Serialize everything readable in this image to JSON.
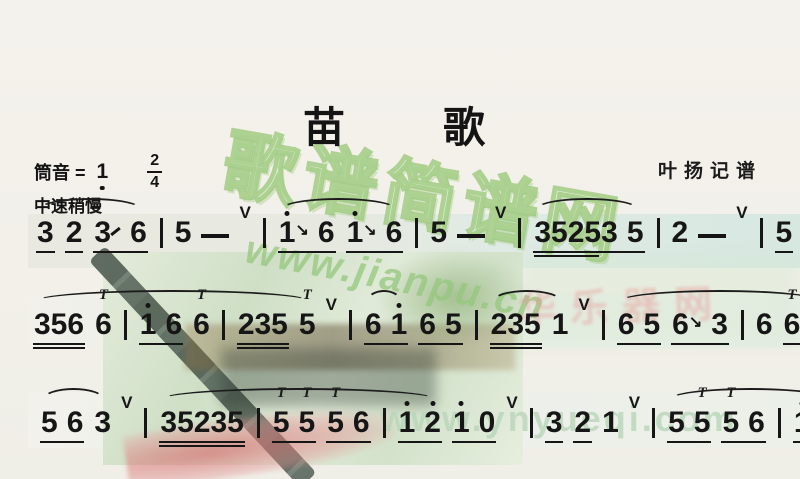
{
  "header": {
    "title": "苗歌",
    "title_chars": [
      "苗",
      "歌"
    ],
    "credit": "叶扬记谱"
  },
  "key_line": {
    "prefix": "筒音 =",
    "tonic": "1",
    "tonic_low_octave": true,
    "time_numerator": "2",
    "time_denominator": "4",
    "tempo": "中速稍慢"
  },
  "watermarks": {
    "bubble": "歌谱简谱网",
    "url_mid": "www.jianpu.cn",
    "url_bottom": "www.ynyueqi.com",
    "pink": "华乐器网"
  },
  "colors": {
    "ink": "#161616",
    "page": "#f2f0e9",
    "watermark_green": "#94c77c",
    "watermark_pale_green": "#b8d6b9",
    "watermark_pink": "#e79292",
    "photo_green": "#cfdfc6",
    "tassel_red": "#d66e6e"
  },
  "score": {
    "glyphs": {
      "ornament": "T",
      "breath": "V",
      "slide_down": "↘"
    },
    "lines_text": [
      "3 2 3/6 | 5 - v| 1'6 1'6 | 5 - v| 35253 5 | 2 - v| 5 5 5 32 |",
      "356 6 | 1' 6 6 | 235 5 v| 6 1' 6 5 | 235 1 v| 6 5 6\\3 | 6 6 1' |",
      "5 6 3 v| 35235 | 5 5 5 6 | 1' 2' 1' 0 v| 3 2 1 v| 5 5 5 6 | 1' 2' 1' 0 ||"
    ],
    "lines": [
      {
        "segments": [
          {
            "slur": true,
            "tokens": [
              {
                "k": "beam",
                "u": 1,
                "notes": [
                  {
                    "t": "3"
                  }
                ]
              },
              {
                "k": "beam",
                "u": 1,
                "notes": [
                  {
                    "t": "2"
                  }
                ]
              },
              {
                "k": "beam",
                "u": 1,
                "notes": [
                  {
                    "t": "3",
                    "slide": "up"
                  },
                  {
                    "t": "6"
                  }
                ]
              }
            ]
          },
          {
            "slur": false,
            "tokens": [
              {
                "k": "bar"
              },
              {
                "k": "note",
                "t": "5"
              },
              {
                "k": "dash"
              },
              {
                "k": "breath"
              },
              {
                "k": "bar"
              }
            ]
          },
          {
            "slur": true,
            "tokens": [
              {
                "k": "beam",
                "u": 1,
                "notes": [
                  {
                    "t": "1",
                    "da": 1,
                    "slide": "down"
                  },
                  {
                    "t": "6"
                  }
                ]
              },
              {
                "k": "beam",
                "u": 1,
                "notes": [
                  {
                    "t": "1",
                    "da": 1,
                    "slide": "down"
                  },
                  {
                    "t": "6"
                  }
                ]
              }
            ]
          },
          {
            "slur": false,
            "tokens": [
              {
                "k": "bar"
              },
              {
                "k": "note",
                "t": "5"
              },
              {
                "k": "dash"
              },
              {
                "k": "breath"
              },
              {
                "k": "bar"
              }
            ]
          },
          {
            "slur": true,
            "tokens": [
              {
                "k": "beam",
                "u": 1,
                "notes": [
                  {
                    "t": "35253",
                    "u2": 0.78
                  },
                  {
                    "t": "5"
                  }
                ]
              }
            ]
          },
          {
            "slur": false,
            "tokens": [
              {
                "k": "bar"
              },
              {
                "k": "note",
                "t": "2"
              },
              {
                "k": "dash"
              },
              {
                "k": "breath"
              },
              {
                "k": "bar"
              },
              {
                "k": "beam",
                "u": 1,
                "notes": [
                  {
                    "t": "5"
                  }
                ]
              },
              {
                "k": "beam",
                "u": 1,
                "notes": [
                  {
                    "t": "5",
                    "orn": 1
                  }
                ]
              },
              {
                "k": "beam",
                "u": 1,
                "notes": [
                  {
                    "t": "5",
                    "orn": 1
                  }
                ]
              },
              {
                "k": "beam",
                "u": 2,
                "notes": [
                  {
                    "t": "32"
                  }
                ]
              },
              {
                "k": "bar"
              }
            ]
          }
        ]
      },
      {
        "segments": [
          {
            "slur": true,
            "tokens": [
              {
                "k": "beam",
                "u": 2,
                "notes": [
                  {
                    "t": "356"
                  }
                ]
              },
              {
                "k": "note",
                "t": "6",
                "orn": 1
              },
              {
                "k": "bar"
              },
              {
                "k": "beam",
                "u": 1,
                "notes": [
                  {
                    "t": "1",
                    "da": 1
                  },
                  {
                    "t": "6"
                  }
                ]
              },
              {
                "k": "note",
                "t": "6",
                "orn": 1
              },
              {
                "k": "bar"
              },
              {
                "k": "beam",
                "u": 2,
                "notes": [
                  {
                    "t": "235"
                  }
                ]
              },
              {
                "k": "note",
                "t": "5",
                "orn": 1
              }
            ]
          },
          {
            "slur": false,
            "tokens": [
              {
                "k": "breath"
              },
              {
                "k": "bar"
              }
            ]
          },
          {
            "slur": true,
            "tokens": [
              {
                "k": "beam",
                "u": 1,
                "notes": [
                  {
                    "t": "6"
                  },
                  {
                    "t": "1",
                    "da": 1
                  }
                ]
              }
            ]
          },
          {
            "slur": false,
            "tokens": [
              {
                "k": "beam",
                "u": 1,
                "notes": [
                  {
                    "t": "6"
                  },
                  {
                    "t": "5"
                  }
                ]
              },
              {
                "k": "bar"
              }
            ]
          },
          {
            "slur": true,
            "tokens": [
              {
                "k": "beam",
                "u": 2,
                "notes": [
                  {
                    "t": "235"
                  }
                ]
              },
              {
                "k": "note",
                "t": "1"
              }
            ]
          },
          {
            "slur": false,
            "tokens": [
              {
                "k": "breath"
              },
              {
                "k": "bar"
              }
            ]
          },
          {
            "slur": true,
            "tokens": [
              {
                "k": "beam",
                "u": 1,
                "notes": [
                  {
                    "t": "6"
                  },
                  {
                    "t": "5"
                  }
                ]
              },
              {
                "k": "beam",
                "u": 1,
                "notes": [
                  {
                    "t": "6",
                    "slide": "down"
                  },
                  {
                    "t": "3"
                  }
                ]
              },
              {
                "k": "bar"
              },
              {
                "k": "note",
                "t": "6"
              },
              {
                "k": "beam",
                "u": 1,
                "notes": [
                  {
                    "t": "6",
                    "orn": 1
                  },
                  {
                    "t": "1",
                    "da": 1
                  }
                ]
              }
            ]
          },
          {
            "slur": false,
            "tokens": [
              {
                "k": "bar"
              }
            ]
          }
        ]
      },
      {
        "segments": [
          {
            "slur": true,
            "tokens": [
              {
                "k": "beam",
                "u": 1,
                "notes": [
                  {
                    "t": "5"
                  },
                  {
                    "t": "6"
                  }
                ]
              },
              {
                "k": "note",
                "t": "3"
              }
            ]
          },
          {
            "slur": false,
            "tokens": [
              {
                "k": "breath"
              },
              {
                "k": "bar"
              }
            ]
          },
          {
            "slur": true,
            "tokens": [
              {
                "k": "beam",
                "u": 2,
                "notes": [
                  {
                    "t": "35235"
                  }
                ]
              },
              {
                "k": "bar"
              },
              {
                "k": "beam",
                "u": 1,
                "notes": [
                  {
                    "t": "5",
                    "orn": 1
                  },
                  {
                    "t": "5",
                    "orn": 1
                  }
                ]
              },
              {
                "k": "beam",
                "u": 1,
                "notes": [
                  {
                    "t": "5",
                    "orn": 1
                  },
                  {
                    "t": "6"
                  }
                ]
              },
              {
                "k": "bar"
              },
              {
                "k": "beam",
                "u": 1,
                "notes": [
                  {
                    "t": "1",
                    "da": 1
                  },
                  {
                    "t": "2",
                    "da": 1
                  }
                ]
              }
            ]
          },
          {
            "slur": false,
            "tokens": [
              {
                "k": "beam",
                "u": 1,
                "notes": [
                  {
                    "t": "1",
                    "da": 1
                  },
                  {
                    "t": "0"
                  }
                ]
              },
              {
                "k": "breath"
              },
              {
                "k": "bar"
              },
              {
                "k": "beam",
                "u": 1,
                "notes": [
                  {
                    "t": "3"
                  }
                ]
              },
              {
                "k": "beam",
                "u": 1,
                "notes": [
                  {
                    "t": "2"
                  }
                ]
              },
              {
                "k": "note",
                "t": "1"
              },
              {
                "k": "breath"
              },
              {
                "k": "bar"
              }
            ]
          },
          {
            "slur": true,
            "tokens": [
              {
                "k": "beam",
                "u": 1,
                "notes": [
                  {
                    "t": "5"
                  },
                  {
                    "t": "5",
                    "orn": 1
                  }
                ]
              },
              {
                "k": "beam",
                "u": 1,
                "notes": [
                  {
                    "t": "5",
                    "orn": 1
                  },
                  {
                    "t": "6"
                  }
                ]
              },
              {
                "k": "bar"
              },
              {
                "k": "beam",
                "u": 1,
                "notes": [
                  {
                    "t": "1",
                    "da": 1
                  },
                  {
                    "t": "2",
                    "da": 1
                  }
                ]
              }
            ]
          },
          {
            "slur": false,
            "tokens": [
              {
                "k": "beam",
                "u": 1,
                "notes": [
                  {
                    "t": "1",
                    "da": 1
                  },
                  {
                    "t": "0"
                  }
                ]
              },
              {
                "k": "dbar"
              }
            ]
          }
        ]
      }
    ]
  }
}
